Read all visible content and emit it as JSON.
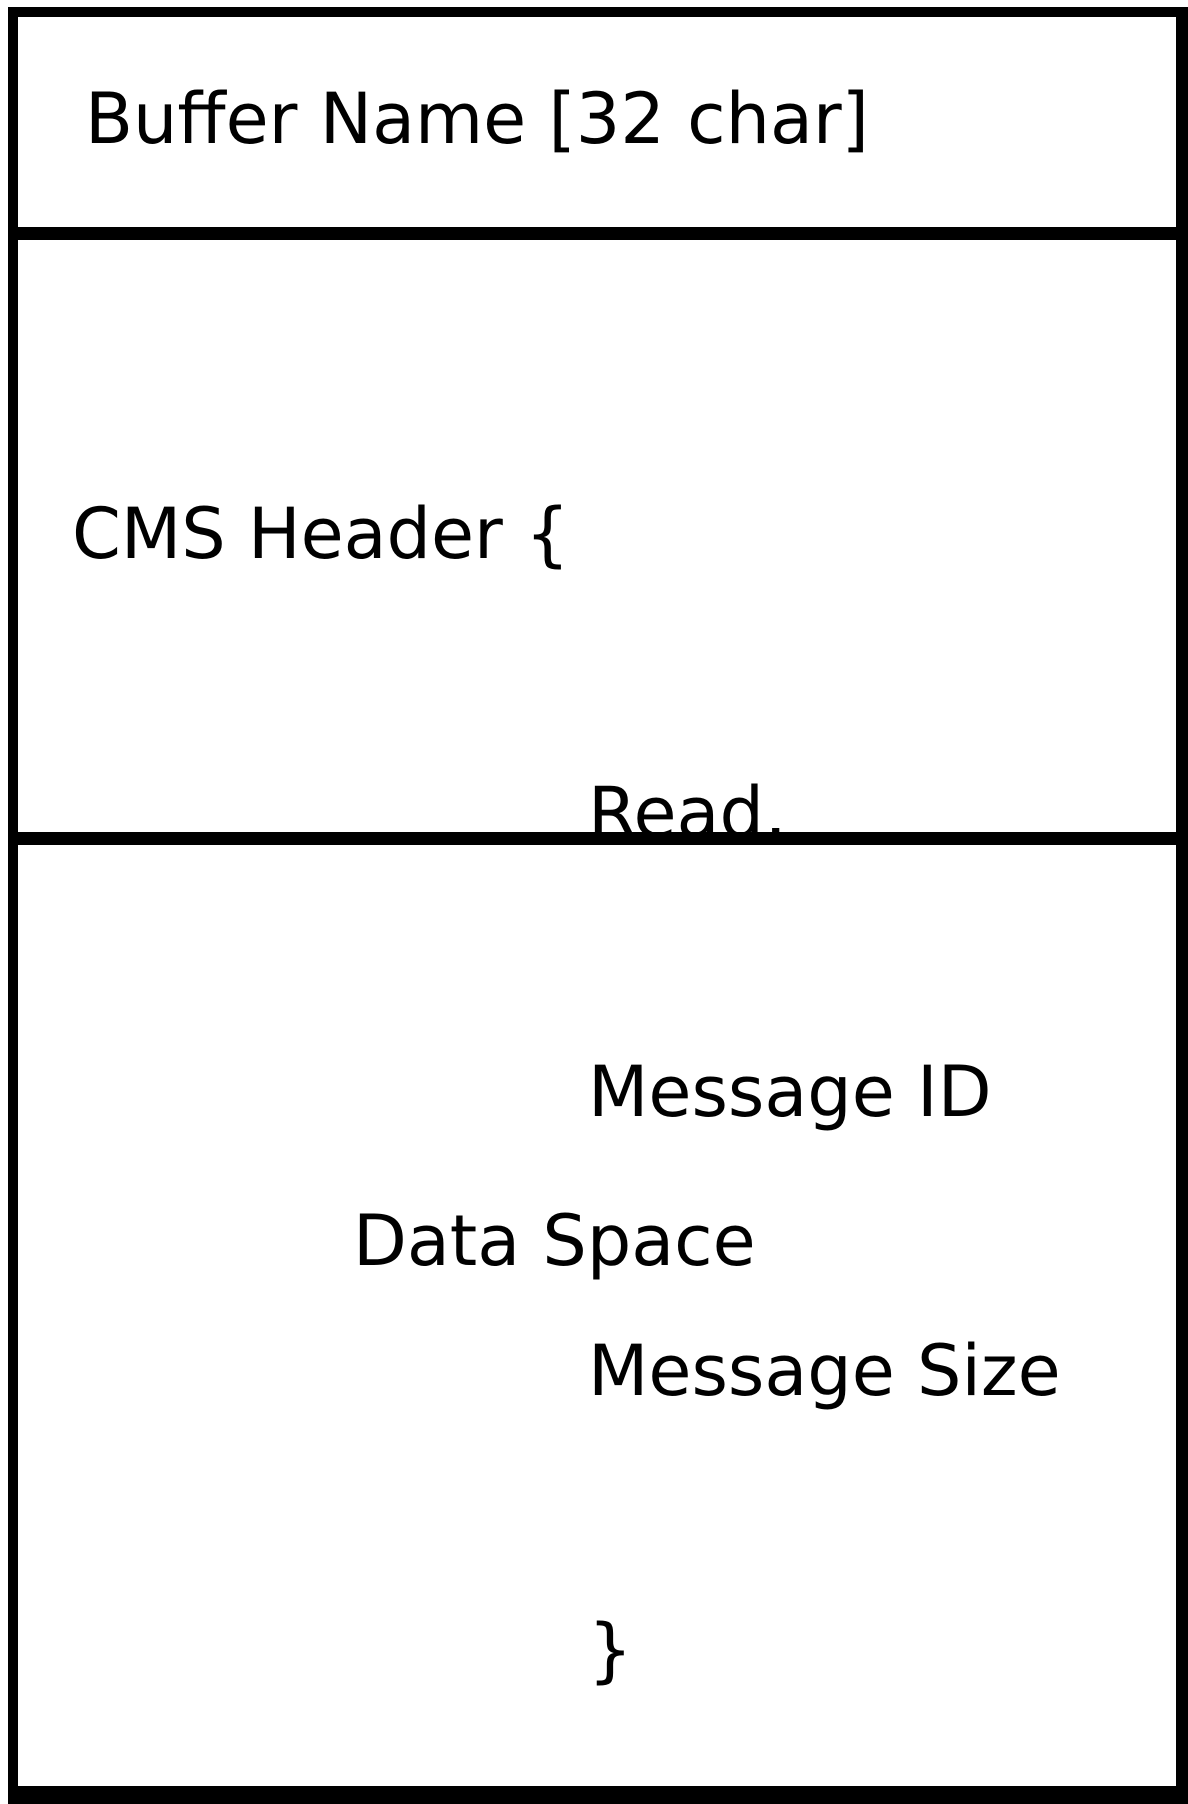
{
  "diagram": {
    "sections": {
      "buffer_name": {
        "label": "Buffer Name [32 char]"
      },
      "cms_header": {
        "open_line": "CMS Header {",
        "fields": [
          "Read,",
          "Message ID",
          "Message Size"
        ],
        "close_brace": "}"
      },
      "data_space": {
        "label": "Data Space"
      }
    },
    "colors": {
      "line": "#000000",
      "background": "#ffffff",
      "text": "#000000"
    }
  }
}
